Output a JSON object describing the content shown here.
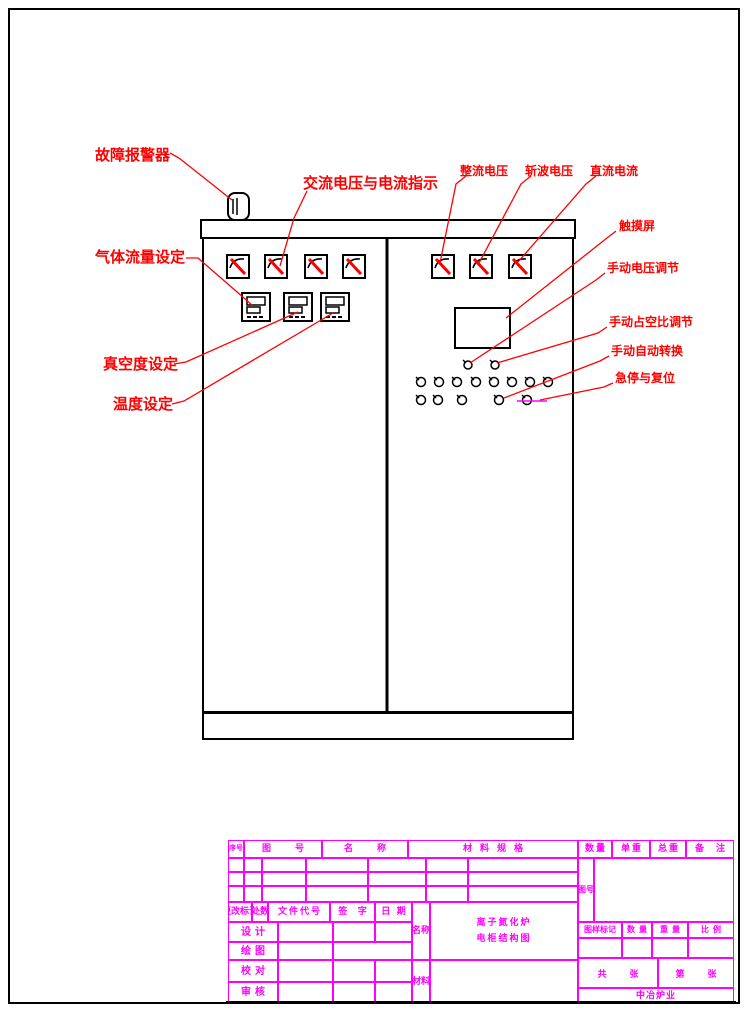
{
  "colors": {
    "line_black": "#000000",
    "annotation_red": "#ff0000",
    "table_magenta": "#ff00ff",
    "title_red": "#ff2400"
  },
  "annotations": {
    "fault_alarm": "故障报警器",
    "ac_indication": "交流电压与电流指示",
    "rect_voltage": "整流电压",
    "chop_voltage": "斩波电压",
    "dc_current": "直流电流",
    "touch_screen": "触摸屏",
    "manual_voltage": "手动电压调节",
    "manual_duty": "手动占空比调节",
    "manual_auto": "手动自动转换",
    "estop_reset": "急停与复位",
    "gas_flow": "气体流量设定",
    "vacuum": "真空度设定",
    "temperature": "温度设定"
  },
  "drawing_title": {
    "line1": "离子氮化炉",
    "line2": "电柜结构图"
  },
  "title_block": {
    "headers": {
      "seq": "序号",
      "drawing_no": "图号",
      "name": "名称",
      "material_spec": "材料规格",
      "qty": "数量",
      "unit_weight": "单重",
      "total_weight": "总重",
      "remarks": "备注"
    },
    "sign_row": {
      "change_mark": "更改标记",
      "count": "处数",
      "doc_code": "文件代号",
      "signature": "签 字",
      "date": "日 期"
    },
    "row_labels": {
      "design": "设计",
      "draw": "绘图",
      "check": "校对",
      "review": "审核"
    },
    "name_label": "名称",
    "material_label": "材料",
    "fig_no_label": "图号",
    "mark_row": {
      "mark": "图样标记",
      "qty": "数量",
      "weight": "重量",
      "scale": "比例"
    },
    "sheets": {
      "total": "共  张",
      "page": "第  张"
    },
    "company": "中冶炉业"
  }
}
